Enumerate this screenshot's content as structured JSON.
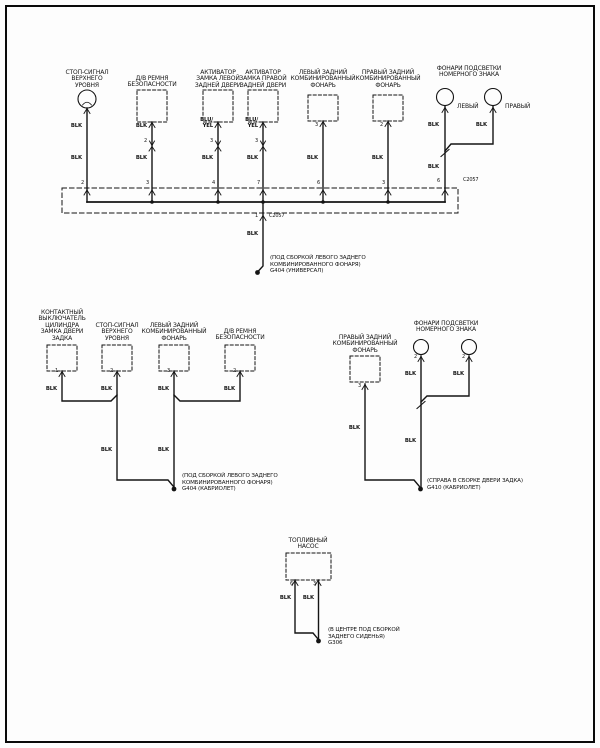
{
  "colors": {
    "ink": "#141414",
    "background": "#fdfdfd"
  },
  "labels": [
    {
      "name": "label-stop-signal-top",
      "text": "СТОП-СИГНАЛ\nВЕРХНЕГО\nУРОВНЯ",
      "x": 87,
      "y": 70,
      "align": "ctr",
      "cls": "comp"
    },
    {
      "name": "label-seatbelt-switch-top",
      "text": "Д/В РЕМНЯ\nБЕЗОПАСНОСТИ",
      "x": 152,
      "y": 76,
      "align": "ctr",
      "cls": "comp"
    },
    {
      "name": "label-lock-actuator-left",
      "text": "АКТИВАТОР\nЗАМКА ЛЕВОЙ\nЗАДНЕЙ ДВЕРИ",
      "x": 218,
      "y": 70,
      "align": "ctr",
      "cls": "comp"
    },
    {
      "name": "label-lock-actuator-right",
      "text": "АКТИВАТОР\nЗАМКА ПРАВОЙ\nЗАДНЕЙ ДВЕРИ",
      "x": 263,
      "y": 70,
      "align": "ctr",
      "cls": "comp"
    },
    {
      "name": "label-left-tail-lamp-top",
      "text": "ЛЕВЫЙ ЗАДНИЙ\nКОМБИНИРОВАННЫЙ\nФОНАРЬ",
      "x": 323,
      "y": 70,
      "align": "ctr",
      "cls": "comp"
    },
    {
      "name": "label-right-tail-lamp-top",
      "text": "ПРАВЫЙ ЗАДНИЙ\nКОМБИНИРОВАННЫЙ\nФОНАРЬ",
      "x": 388,
      "y": 70,
      "align": "ctr",
      "cls": "comp"
    },
    {
      "name": "label-license-lamps-top",
      "text": "ФОНАРИ ПОДСВЕТКИ\nНОМЕРНОГО ЗНАКА",
      "x": 469,
      "y": 66,
      "align": "ctr",
      "cls": "comp"
    },
    {
      "name": "label-license-left",
      "text": "ЛЕВЫЙ",
      "x": 457,
      "y": 104,
      "cls": "comp"
    },
    {
      "name": "label-license-right",
      "text": "ПРАВЫЙ",
      "x": 505,
      "y": 104,
      "cls": "comp"
    },
    {
      "name": "wire-blk-stop-upper",
      "text": "BLK",
      "x": 82,
      "y": 124,
      "align": "rgt",
      "cls": "wire"
    },
    {
      "name": "wire-blk-stop-lower",
      "text": "BLK",
      "x": 82,
      "y": 156,
      "align": "rgt",
      "cls": "wire"
    },
    {
      "name": "wire-blk-seatbelt-upper",
      "text": "BLK",
      "x": 147,
      "y": 124,
      "align": "rgt",
      "cls": "wire"
    },
    {
      "name": "pin-seatbelt-inline",
      "text": "2",
      "x": 147,
      "y": 139,
      "align": "rgt",
      "cls": "pin"
    },
    {
      "name": "wire-blk-seatbelt-lower",
      "text": "BLK",
      "x": 147,
      "y": 156,
      "align": "rgt",
      "cls": "wire"
    },
    {
      "name": "wire-bluyel-actuator-left",
      "text": "BLU/\nYEL",
      "x": 213,
      "y": 118,
      "align": "rgt",
      "cls": "wire"
    },
    {
      "name": "pin-actuator-left-inline",
      "text": "3",
      "x": 213,
      "y": 139,
      "align": "rgt",
      "cls": "pin"
    },
    {
      "name": "wire-blk-actuator-left",
      "text": "BLK",
      "x": 213,
      "y": 156,
      "align": "rgt",
      "cls": "wire"
    },
    {
      "name": "wire-bluyel-actuator-right",
      "text": "BLU/\nYEL",
      "x": 258,
      "y": 118,
      "align": "rgt",
      "cls": "wire"
    },
    {
      "name": "pin-actuator-right-inline",
      "text": "3",
      "x": 258,
      "y": 139,
      "align": "rgt",
      "cls": "pin"
    },
    {
      "name": "wire-blk-actuator-right",
      "text": "BLK",
      "x": 258,
      "y": 156,
      "align": "rgt",
      "cls": "wire"
    },
    {
      "name": "pin-left-tail-top",
      "text": "3",
      "x": 318,
      "y": 123,
      "align": "rgt",
      "cls": "pin"
    },
    {
      "name": "wire-blk-left-tail",
      "text": "BLK",
      "x": 318,
      "y": 156,
      "align": "rgt",
      "cls": "wire"
    },
    {
      "name": "pin-right-tail-top",
      "text": "2",
      "x": 383,
      "y": 123,
      "align": "rgt",
      "cls": "pin"
    },
    {
      "name": "wire-blk-right-tail",
      "text": "BLK",
      "x": 383,
      "y": 156,
      "align": "rgt",
      "cls": "wire"
    },
    {
      "name": "wire-blk-license-left-top",
      "text": "BLK",
      "x": 439,
      "y": 123,
      "align": "rgt",
      "cls": "wire"
    },
    {
      "name": "wire-blk-license-right-top",
      "text": "BLK",
      "x": 487,
      "y": 123,
      "align": "rgt",
      "cls": "wire"
    },
    {
      "name": "wire-blk-license-splice",
      "text": "BLK",
      "x": 439,
      "y": 165,
      "align": "rgt",
      "cls": "wire"
    },
    {
      "name": "pin-license-bus",
      "text": "6",
      "x": 440,
      "y": 179,
      "align": "rgt",
      "cls": "pin"
    },
    {
      "name": "connector-c2057-top",
      "text": "C2057",
      "x": 463,
      "y": 178,
      "cls": "pin"
    },
    {
      "name": "pin-bus-stop",
      "text": "2",
      "x": 84,
      "y": 181,
      "align": "rgt",
      "cls": "pin"
    },
    {
      "name": "pin-bus-seatbelt",
      "text": "3",
      "x": 149,
      "y": 181,
      "align": "rgt",
      "cls": "pin"
    },
    {
      "name": "pin-bus-actuator-left",
      "text": "4",
      "x": 215,
      "y": 181,
      "align": "rgt",
      "cls": "pin"
    },
    {
      "name": "pin-bus-actuator-right",
      "text": "7",
      "x": 260,
      "y": 181,
      "align": "rgt",
      "cls": "pin"
    },
    {
      "name": "pin-bus-left-tail",
      "text": "6",
      "x": 320,
      "y": 181,
      "align": "rgt",
      "cls": "pin"
    },
    {
      "name": "pin-bus-right-tail",
      "text": "3",
      "x": 385,
      "y": 181,
      "align": "rgt",
      "cls": "pin"
    },
    {
      "name": "pin-bus-exit",
      "text": "1",
      "x": 258,
      "y": 214,
      "align": "rgt",
      "cls": "pin"
    },
    {
      "name": "connector-c2057-exit",
      "text": "C2057",
      "x": 269,
      "y": 214,
      "cls": "pin"
    },
    {
      "name": "wire-blk-ground-univ",
      "text": "BLK",
      "x": 258,
      "y": 232,
      "align": "rgt",
      "cls": "wire"
    },
    {
      "name": "ground-g404-universal",
      "text": "(ПОД СБОРКОЙ ЛЕВОГО ЗАДНЕГО\nКОМБИНИРОВАННОГО ФОНАРЯ)\nG404 (УНИВЕРСАЛ)",
      "x": 270,
      "y": 255,
      "cls": "gnd"
    },
    {
      "name": "label-tailgate-lock-switch",
      "text": "КОНТАКТНЫЙ\nВЫКЛЮЧАТЕЛЬ\nЦИЛИНДРА\nЗАМКА ДВЕРИ\nЗАДКА",
      "x": 62,
      "y": 310,
      "align": "ctr",
      "cls": "comp"
    },
    {
      "name": "label-stop-signal-mid",
      "text": "СТОП-СИГНАЛ\nВЕРХНЕГО\nУРОВНЯ",
      "x": 117,
      "y": 323,
      "align": "ctr",
      "cls": "comp"
    },
    {
      "name": "label-left-tail-lamp-mid",
      "text": "ЛЕВЫЙ ЗАДНИЙ\nКОМБИНИРОВАННЫЙ\nФОНАРЬ",
      "x": 174,
      "y": 323,
      "align": "ctr",
      "cls": "comp"
    },
    {
      "name": "label-seatbelt-switch-mid",
      "text": "Д/В РЕМНЯ\nБЕЗОПАСНОСТИ",
      "x": 240,
      "y": 329,
      "align": "ctr",
      "cls": "comp"
    },
    {
      "name": "pin-lock-switch",
      "text": "1",
      "x": 58,
      "y": 369,
      "align": "rgt",
      "cls": "pin"
    },
    {
      "name": "pin-stop-mid",
      "text": "2",
      "x": 113,
      "y": 369,
      "align": "rgt",
      "cls": "pin"
    },
    {
      "name": "pin-left-tail-mid",
      "text": "3",
      "x": 170,
      "y": 369,
      "align": "rgt",
      "cls": "pin"
    },
    {
      "name": "pin-seatbelt-mid",
      "text": "2",
      "x": 236,
      "y": 369,
      "align": "rgt",
      "cls": "pin"
    },
    {
      "name": "wire-blk-lock-switch",
      "text": "BLK",
      "x": 57,
      "y": 387,
      "align": "rgt",
      "cls": "wire"
    },
    {
      "name": "wire-blk-stop-mid",
      "text": "BLK",
      "x": 112,
      "y": 387,
      "align": "rgt",
      "cls": "wire"
    },
    {
      "name": "wire-blk-left-tail-mid",
      "text": "BLK",
      "x": 169,
      "y": 387,
      "align": "rgt",
      "cls": "wire"
    },
    {
      "name": "wire-blk-seatbelt-mid",
      "text": "BLK",
      "x": 235,
      "y": 387,
      "align": "rgt",
      "cls": "wire"
    },
    {
      "name": "wire-blk-stop-mid-lower",
      "text": "BLK",
      "x": 112,
      "y": 448,
      "align": "rgt",
      "cls": "wire"
    },
    {
      "name": "wire-blk-left-tail-mid-lower",
      "text": "BLK",
      "x": 169,
      "y": 448,
      "align": "rgt",
      "cls": "wire"
    },
    {
      "name": "ground-g404-cabrio",
      "text": "(ПОД СБОРКОЙ ЛЕВОГО ЗАДНЕГО\nКОМБИНИРОВАННОГО ФОНАРЯ)\nG404 (КАБРИОЛЕТ)",
      "x": 182,
      "y": 473,
      "cls": "gnd"
    },
    {
      "name": "label-right-tail-lamp-mid",
      "text": "ПРАВЫЙ ЗАДНИЙ\nКОМБИНИРОВАННЫЙ\nФОНАРЬ",
      "x": 365,
      "y": 335,
      "align": "ctr",
      "cls": "comp"
    },
    {
      "name": "label-license-lamps-mid",
      "text": "ФОНАРИ ПОДСВЕТКИ\nНОМЕРНОГО ЗНАКА",
      "x": 446,
      "y": 321,
      "align": "ctr",
      "cls": "comp"
    },
    {
      "name": "pin-right-tail-mid",
      "text": "3",
      "x": 361,
      "y": 384,
      "align": "rgt",
      "cls": "pin"
    },
    {
      "name": "pin-license-left-mid",
      "text": "2",
      "x": 417,
      "y": 355,
      "align": "rgt",
      "cls": "pin"
    },
    {
      "name": "pin-license-right-mid",
      "text": "2",
      "x": 465,
      "y": 355,
      "align": "rgt",
      "cls": "pin"
    },
    {
      "name": "wire-blk-license-left-mid",
      "text": "BLK",
      "x": 416,
      "y": 372,
      "align": "rgt",
      "cls": "wire"
    },
    {
      "name": "wire-blk-license-right-mid",
      "text": "BLK",
      "x": 464,
      "y": 372,
      "align": "rgt",
      "cls": "wire"
    },
    {
      "name": "wire-blk-right-tail-mid",
      "text": "BLK",
      "x": 360,
      "y": 426,
      "align": "rgt",
      "cls": "wire"
    },
    {
      "name": "wire-blk-license-mid-lower",
      "text": "BLK",
      "x": 416,
      "y": 439,
      "align": "rgt",
      "cls": "wire"
    },
    {
      "name": "ground-g410",
      "text": "(СПРАВА В СБОРКЕ ДВЕРИ ЗАДКА)\nG410 (КАБРИОЛЕТ)",
      "x": 427,
      "y": 478,
      "cls": "gnd"
    },
    {
      "name": "label-fuel-pump",
      "text": "ТОПЛИВНЫЙ\nНАСОС",
      "x": 308,
      "y": 538,
      "align": "ctr",
      "cls": "comp"
    },
    {
      "name": "pin-fuel-left",
      "text": "6",
      "x": 293,
      "y": 582,
      "align": "rgt",
      "cls": "pin"
    },
    {
      "name": "pin-fuel-right",
      "text": "3",
      "x": 316,
      "y": 582,
      "align": "rgt",
      "cls": "pin"
    },
    {
      "name": "wire-blk-fuel-left",
      "text": "BLK",
      "x": 291,
      "y": 596,
      "align": "rgt",
      "cls": "wire"
    },
    {
      "name": "wire-blk-fuel-right",
      "text": "BLK",
      "x": 314,
      "y": 596,
      "align": "rgt",
      "cls": "wire"
    },
    {
      "name": "ground-g306",
      "text": "(В ЦЕНТРЕ ПОД СБОРКОЙ\nЗАДНЕГО СИДЕНЬЯ)\nG306",
      "x": 328,
      "y": 627,
      "cls": "gnd"
    }
  ]
}
